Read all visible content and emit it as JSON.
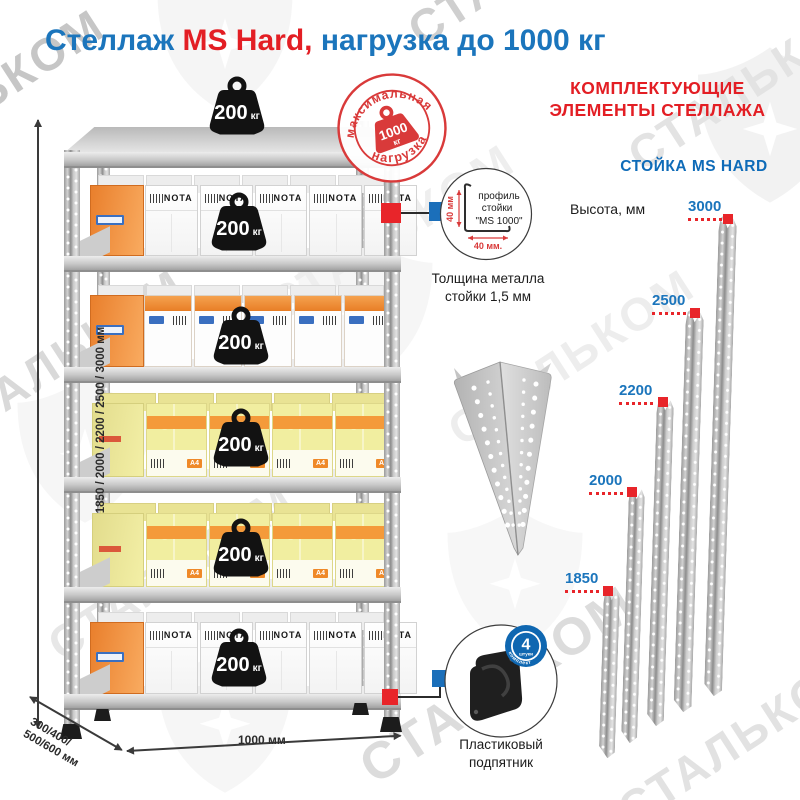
{
  "title": {
    "part1": "Стеллаж ",
    "part2": "MS Hard,",
    "part3": " нагрузка до 1000 кг"
  },
  "watermark": {
    "text": "СТАЛЬКОМ"
  },
  "colors": {
    "blue": "#1b75bc",
    "red": "#e31e24",
    "badge_blue": "#0f67b1",
    "stamp_red": "#d93a3a"
  },
  "stamp": {
    "top_text": "максимальная",
    "bottom_text": "нагрузка",
    "value": "1000",
    "unit": "кг"
  },
  "unit": {
    "shelf_load": {
      "value": "200",
      "unit": "кг"
    },
    "height_label": "1850 / 2000 / 2200 / 2500 / 3000 мм",
    "depth_label_line1": "300/400/",
    "depth_label_line2": "500/600 мм",
    "width_label": "1000 мм"
  },
  "boxes": {
    "nota_label": "NOTA",
    "paper_label": "A4"
  },
  "profile_detail": {
    "line1": "профиль",
    "line2": "стойки",
    "line3": "\"MS 1000\"",
    "dim_vertical": "40 мм",
    "dim_horizontal": "40 мм.",
    "caption": "Толщина металла стойки 1,5 мм"
  },
  "foot_detail": {
    "caption": "Пластиковый подпятник",
    "badge_count": "4",
    "badge_unit": "штуки",
    "badge_note": "в комплекте"
  },
  "components_panel": {
    "heading_line1": "КОМПЛЕКТУЮЩИЕ",
    "heading_line2": "ЭЛЕМЕНТЫ СТЕЛЛАЖА",
    "post_title": "СТОЙКА MS HARD",
    "height_caption": "Высота, мм",
    "post_heights": [
      "3000",
      "2500",
      "2200",
      "2000",
      "1850"
    ]
  }
}
